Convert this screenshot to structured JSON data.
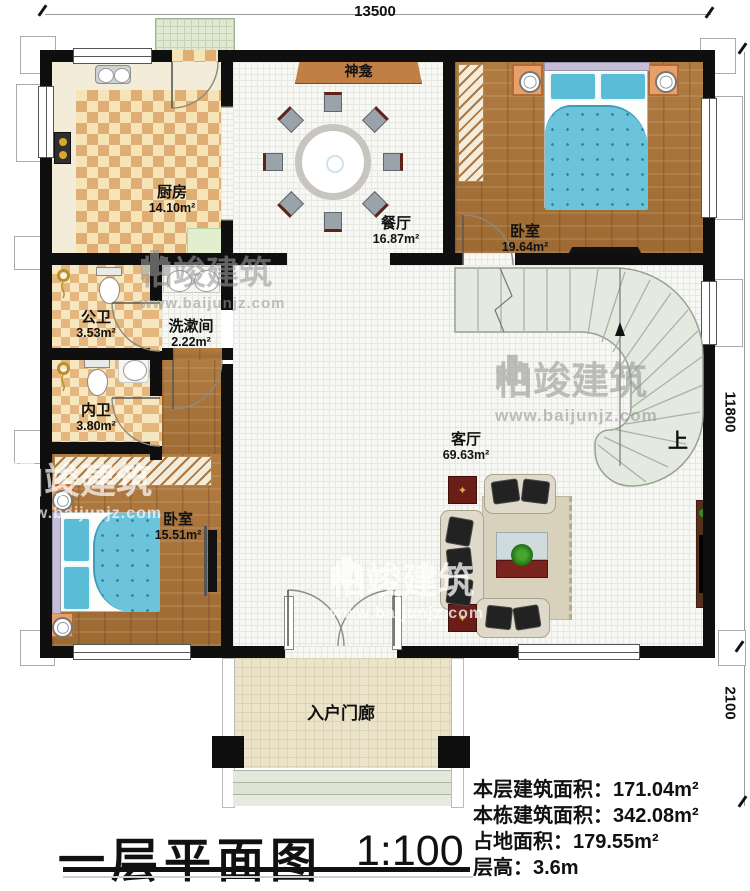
{
  "dimensions": {
    "top": "13500",
    "right_upper": "11800",
    "right_lower": "2100"
  },
  "rooms": [
    {
      "id": "kitchen",
      "name": "厨房",
      "area": "14.10m²"
    },
    {
      "id": "dining",
      "name": "餐厅",
      "area": "16.87m²"
    },
    {
      "id": "bedroom_top",
      "name": "卧室",
      "area": "19.64m²"
    },
    {
      "id": "public_bath",
      "name": "公卫",
      "area": "3.53m²"
    },
    {
      "id": "washroom",
      "name": "洗漱间",
      "area": "2.22m²"
    },
    {
      "id": "private_bath",
      "name": "内卫",
      "area": "3.80m²"
    },
    {
      "id": "bedroom_bottom",
      "name": "卧室",
      "area": "15.51m²"
    },
    {
      "id": "living",
      "name": "客厅",
      "area": "69.63m²"
    },
    {
      "id": "porch",
      "name": "入户门廊",
      "area": ""
    }
  ],
  "labels": {
    "shrine": "神龛",
    "stairs_up": "上"
  },
  "title": {
    "main": "一层平面图",
    "scale": "1:100"
  },
  "stats": [
    {
      "label": "本层建筑面积：",
      "value": "171.04m²"
    },
    {
      "label": "本栋建筑面积：",
      "value": "342.08m²"
    },
    {
      "label": "占地面积：",
      "value": "179.55m²"
    },
    {
      "label": "层高：",
      "value": "3.6m"
    }
  ],
  "watermark": {
    "brand": "柏竣建筑",
    "url": "www.baijunjz.com"
  },
  "colors": {
    "wall": "#0f0f0f",
    "wood_floor": "#a9743c",
    "tile_light": "#f6e4b6",
    "tile_dark": "#dfae74",
    "bed_blue": "#6cc4dc",
    "banner_brown": "#c08045",
    "stairs_green": "#e4eae0",
    "porch_beige": "#ece4ca"
  }
}
